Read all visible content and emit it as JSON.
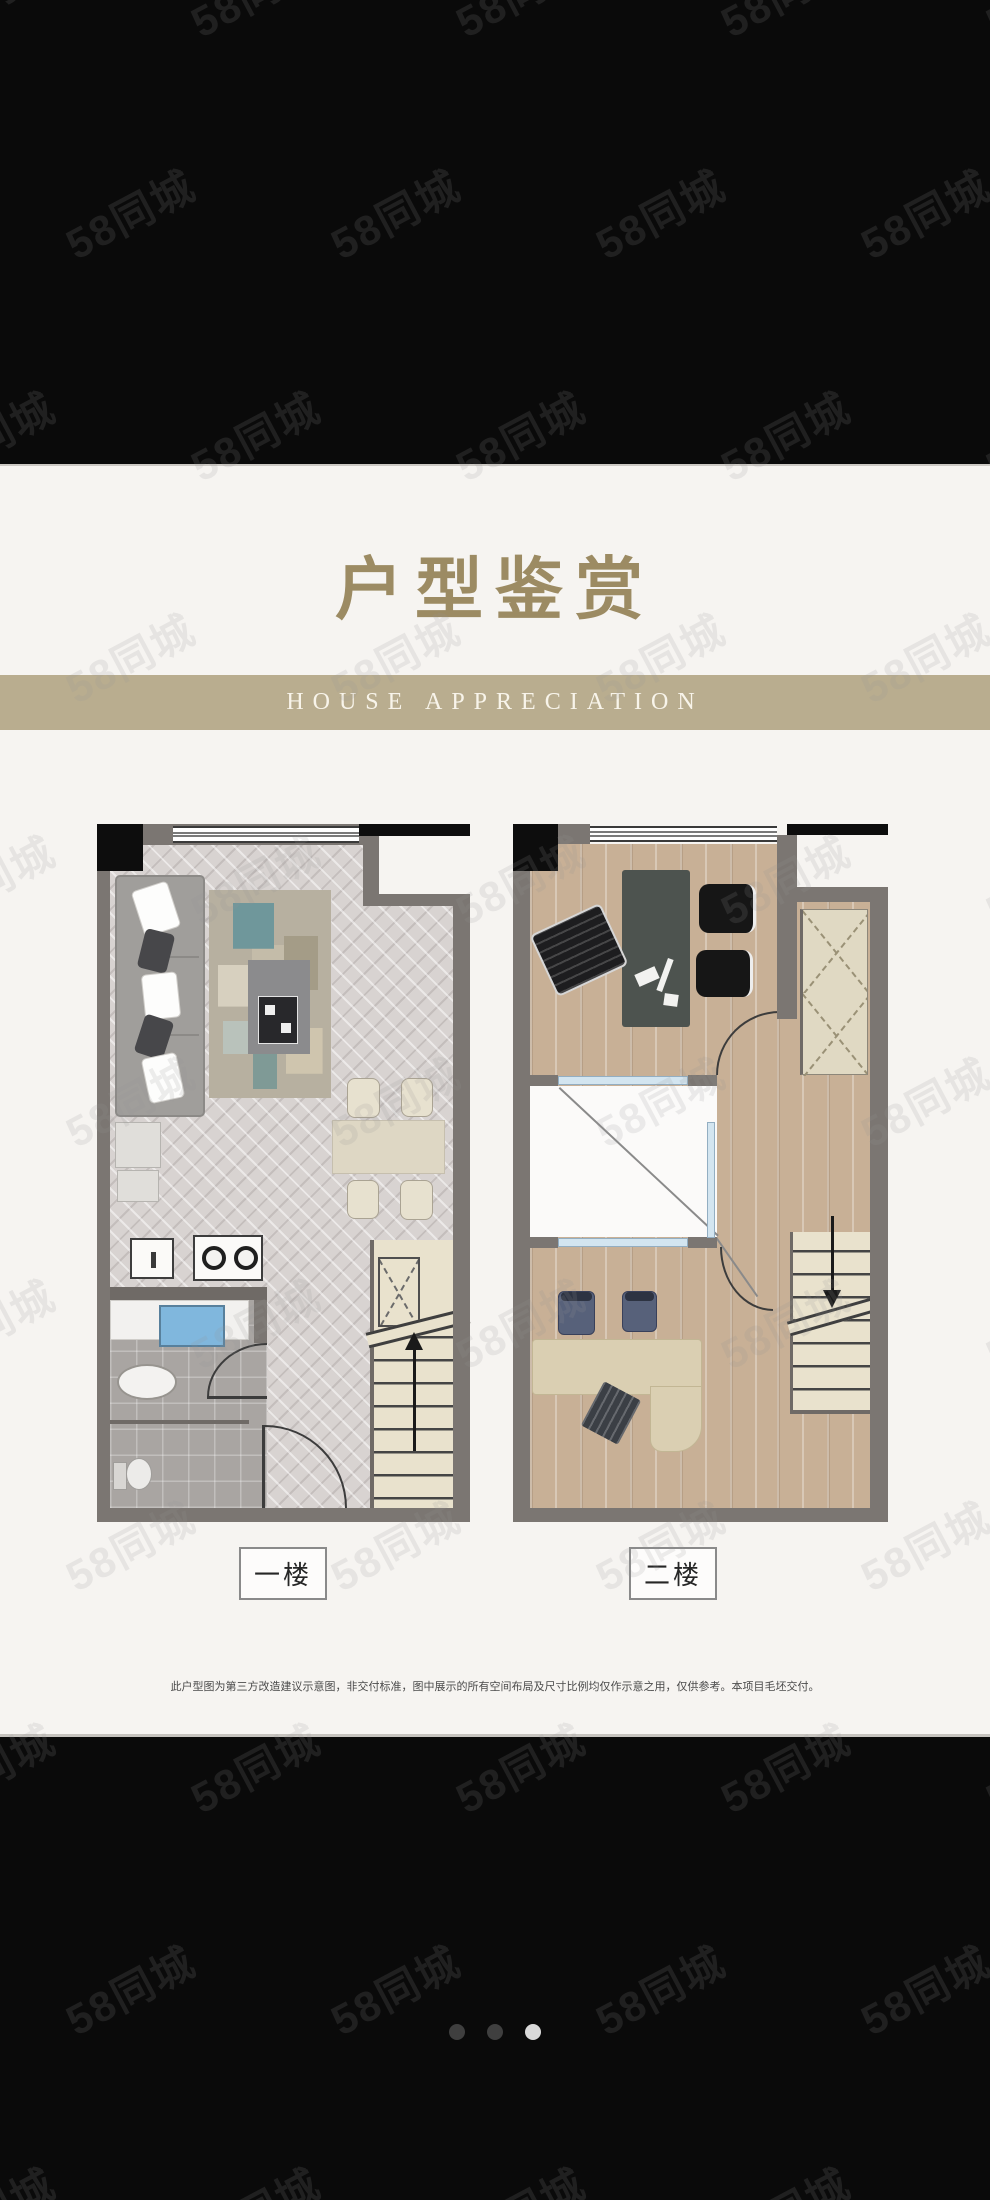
{
  "header": {
    "title": "户型鉴赏",
    "subtitle": "HOUSE APPRECIATION"
  },
  "plans": [
    {
      "label": "一楼",
      "name": "first-floor"
    },
    {
      "label": "二楼",
      "name": "second-floor"
    }
  ],
  "footer": {
    "disclaimer": "此户型图为第三方改造建议示意图，非交付标准，图中展示的所有空间布局及尺寸比例均仅作示意之用，仅供参考。本项目毛坯交付。"
  },
  "watermark": {
    "text": "58同城"
  },
  "carousel": {
    "dots": [
      {
        "active": false
      },
      {
        "active": false
      },
      {
        "active": true
      }
    ]
  },
  "palette": {
    "page-black": "#0a0a0a",
    "panel-bg": "#f6f4f1",
    "gold": "#9c8b63",
    "band": "#b9ad8f",
    "band-text": "#f8f4ea",
    "wall": "#7b7672",
    "wall-dark": "#6f6a66",
    "stair": "#e9e2cd",
    "glass": "#d3e5f0",
    "wood": "#c8b096",
    "herringbone": "#d8d3d1",
    "tile": "#a9a5a2",
    "void-bg": "#fbfaf9",
    "label-border": "#8a8a8a",
    "disclaimer": "#4b4b4b",
    "dot-inactive": "#3f3f3f",
    "dot-active": "#d9d9d9",
    "watermark": "rgba(148,148,148,0.16)"
  }
}
